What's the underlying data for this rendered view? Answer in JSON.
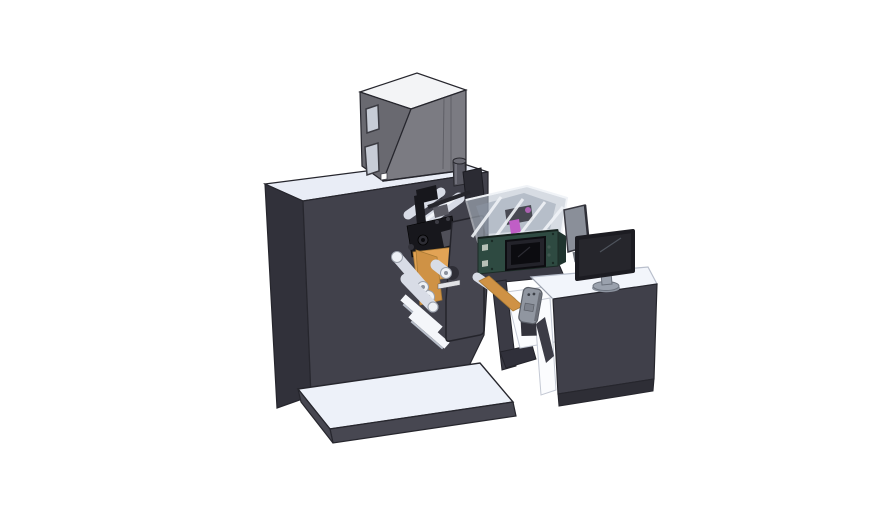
{
  "canvas": {
    "width": 888,
    "height": 522,
    "background": "#ffffff"
  },
  "scene": {
    "description": "3D CAD isometric render on a white background: a dark label-press machine cabinet with a grey fume-extractor box on top, an unwind turret with rollers and an orange label web, a dark-green digital print unit with a translucent ink-bay cover and small control display, and an operator desk with a monitor and hand pendant.",
    "visible_text": []
  },
  "palette": {
    "bg": "#ffffff",
    "machineFront": "#41414b",
    "machineSide": "#31313a",
    "machineTop": "#e9edf6",
    "outline": "#26262d",
    "cabinetFront": "#7b7b82",
    "cabinetSide": "#696970",
    "cabinetTop": "#f3f4f6",
    "windowGrey": "#c7ccd6",
    "platformTop": "#edf1f9",
    "platformSide": "#474751",
    "roller": "#d8dce6",
    "rollerHl": "#f4f6fa",
    "webOrange": "#e2a355",
    "webOrangeDark": "#cf9245",
    "pressGreen": "#2e4a41",
    "pressGreenDark": "#1f342e",
    "displayBezel": "#23232a",
    "displayScreen": "#0c0c10",
    "acrylic": "#b7c1cd",
    "acrylicFrame": "#e6ebf1",
    "inkMagenta": "#c05ec6",
    "deskFront": "#40404a",
    "deskDark": "#2e2e36",
    "monitorScreen": "#26262c",
    "monitorStand": "#9aa1ad",
    "panelGray": "#8a8f99",
    "headBlack": "#17171c",
    "headGray": "#4f4f58",
    "pendant": "#9096a0"
  },
  "parts": [
    "main-machine-cabinet",
    "fume-extractor-box",
    "exhaust-pipe",
    "unwind-turret-plate",
    "web-rollers",
    "label-web",
    "print-head-assembly",
    "digital-press-unit",
    "ink-bay-cover",
    "control-display",
    "press-stand",
    "hand-pendant",
    "base-platform",
    "operator-desk",
    "side-guard-panel",
    "desktop-monitor"
  ]
}
